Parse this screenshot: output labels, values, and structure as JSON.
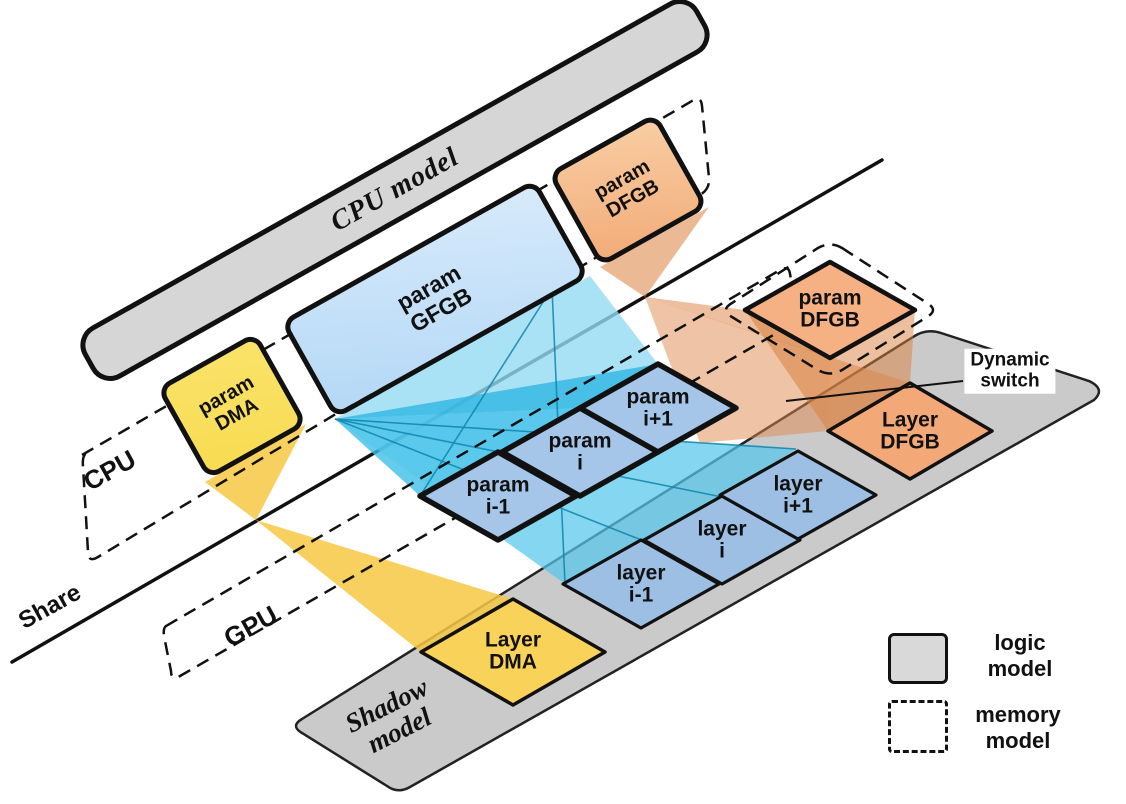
{
  "bars": {
    "cpu_model": "CPU model",
    "shadow_model": "Shadow\nmodel"
  },
  "regions": {
    "cpu": "CPU",
    "gpu": "GPU",
    "share": "Share"
  },
  "boxes": {
    "param_dma": "param\nDMA",
    "param_gfgb": "param\nGFGB",
    "param_dfgb_cpu": "param\nDFGB",
    "param_prev": "param\ni-1",
    "param_cur": "param\ni",
    "param_next": "param\ni+1",
    "param_dfgb_mem": "param\nDFGB",
    "layer_prev": "layer\ni-1",
    "layer_cur": "layer\ni",
    "layer_next": "layer\ni+1",
    "layer_dma": "Layer\nDMA",
    "layer_dfgb": "Layer\nDFGB"
  },
  "annotations": {
    "dynamic_switch": "Dynamic\nswitch"
  },
  "legend": {
    "logic": "logic\nmodel",
    "memory": "memory\nmodel"
  },
  "colors": {
    "bar_gray": "#D6D6D6",
    "shadow_gray": "#CACACA",
    "param_yellow": "#F9E05E",
    "layer_yellow": "#F9D25A",
    "gfgb_blue": "#C5E0F8",
    "param_blue": "#A6C6E9",
    "layer_blue": "#9DBFE3",
    "dfgb_orange": "#F5B084",
    "layer_orange": "#F2A977",
    "beam_cyan": "#3FBFE8",
    "beam_yellow": "#F7C843",
    "beam_orange": "#E08A4E"
  }
}
